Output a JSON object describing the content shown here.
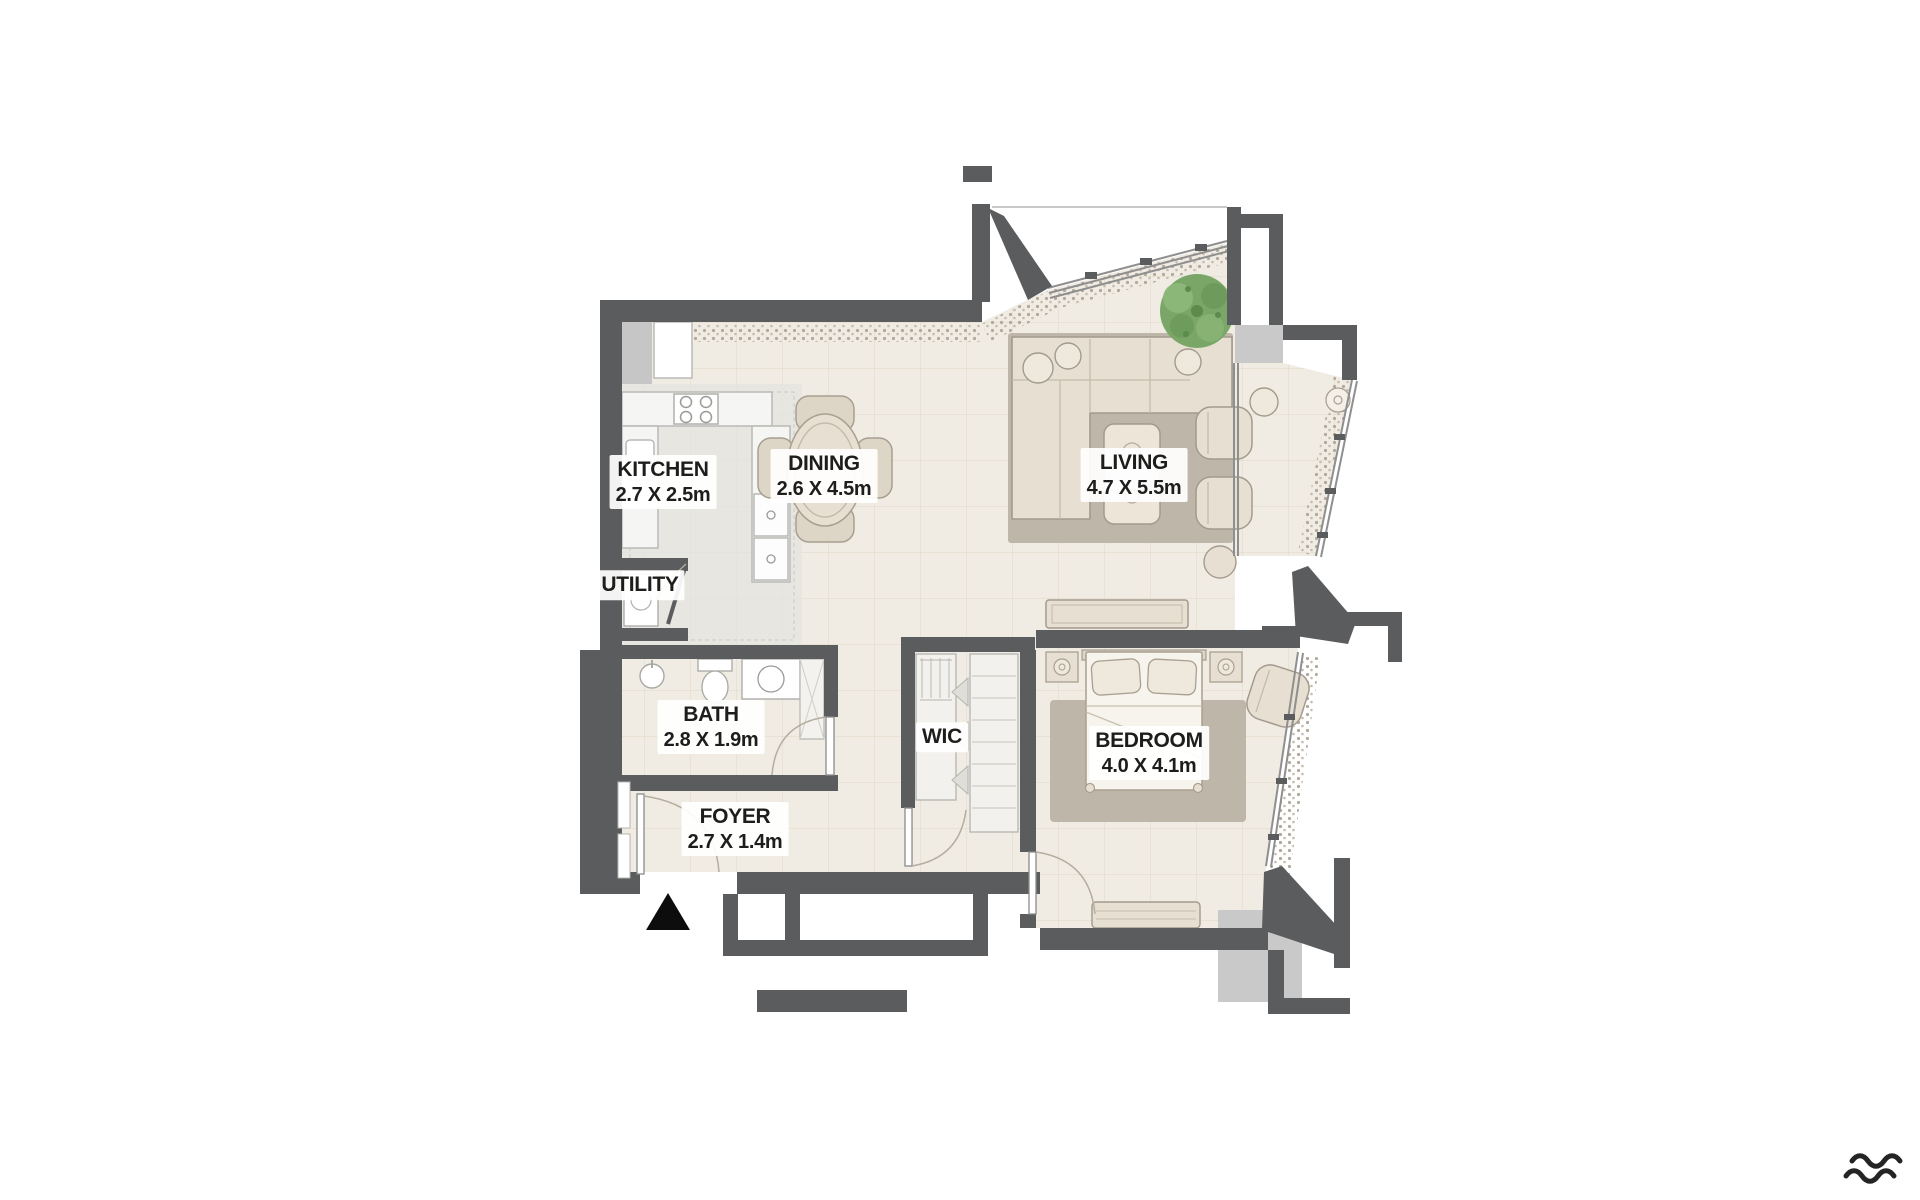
{
  "plan": {
    "title": "one-bedroom apartment floor plan",
    "rooms": [
      {
        "name": "KITCHEN",
        "dims": "2.7 X 2.5m"
      },
      {
        "name": "DINING",
        "dims": "2.6 X 4.5m"
      },
      {
        "name": "LIVING",
        "dims": "4.7 X 5.5m"
      },
      {
        "name": "UTILITY",
        "dims": ""
      },
      {
        "name": "BATH",
        "dims": "2.8 X 1.9m"
      },
      {
        "name": "WIC",
        "dims": ""
      },
      {
        "name": "BEDROOM",
        "dims": "4.0 X 4.1m"
      },
      {
        "name": "FOYER",
        "dims": "2.7 X 1.4m"
      }
    ],
    "icons": {
      "entrance_marker": "entrance-triangle-icon",
      "logo": "waves-logo-icon"
    },
    "colors": {
      "wall": "#5b5c5e",
      "floor": "#f1ece3",
      "tile_line": "#e3dccd",
      "rug": "#bfb6aa",
      "furniture": "#e7e0d2",
      "furniture_stroke": "#a39a8d",
      "kitchen_floor": "#e3e4e0",
      "shaft": "#c9c9c9",
      "tree": "#75a565",
      "label_text": "#1d1d1b",
      "marker": "#0d0d0d"
    }
  }
}
